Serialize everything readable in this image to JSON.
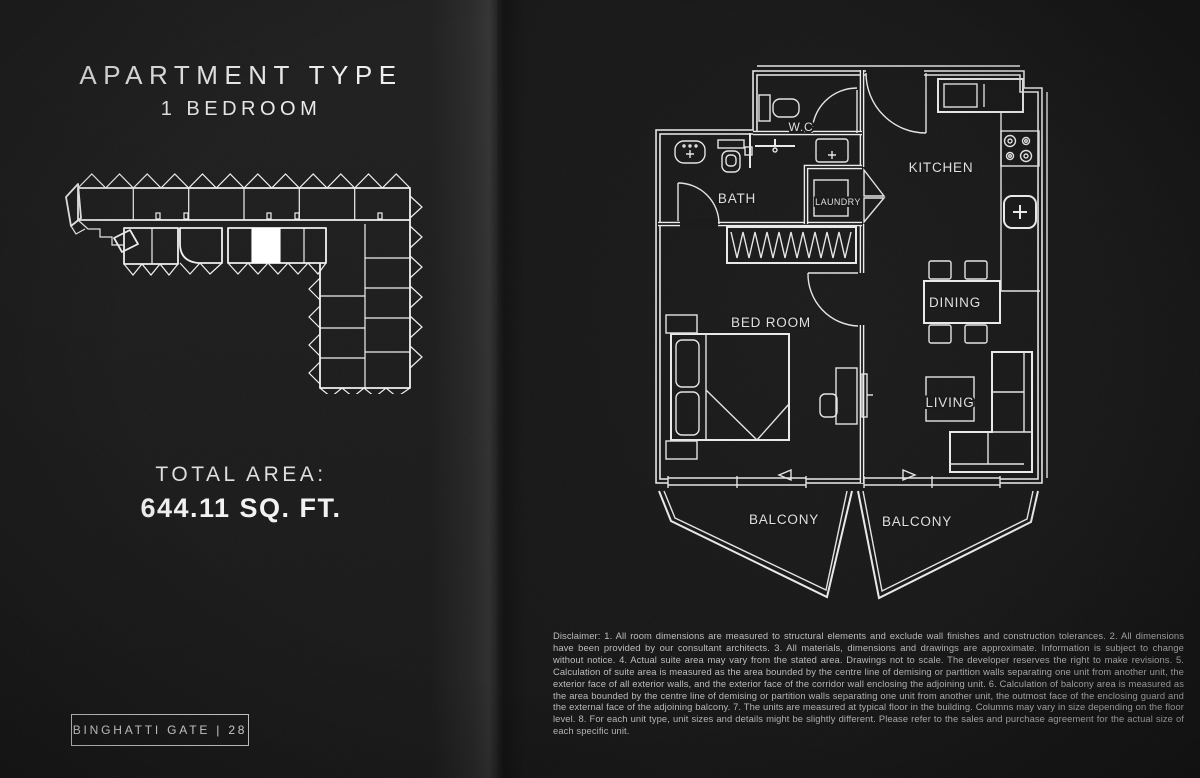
{
  "left_page": {
    "title": "APARTMENT TYPE",
    "subtitle": "1 BEDROOM",
    "total_area_label": "TOTAL AREA:",
    "total_area_value": "644.11 SQ. FT.",
    "badge": "BINGHATTI GATE | 28"
  },
  "floor_plan": {
    "rooms": {
      "wc": "W.C",
      "bath": "BATH",
      "laundry": "LAUNDRY",
      "kitchen": "KITCHEN",
      "bedroom": "BED ROOM",
      "dining": "DINING",
      "living": "LIVING",
      "balcony_left": "BALCONY",
      "balcony_right": "BALCONY"
    }
  },
  "disclaimer": "Disclaimer: 1. All room dimensions are measured to structural elements and exclude wall finishes and construction tolerances. 2. All dimensions have been provided by our consultant architects. 3. All materials, dimensions and drawings are approximate. Information is subject to change without notice. 4. Actual suite area may vary from the stated area. Drawings not to scale. The developer reserves the right to make revisions. 5. Calculation of suite area is measured as the area bounded by the centre line of demising or partition walls separating one unit from another unit, the exterior face of all exterior walls, and the exterior face of the corridor wall enclosing the adjoining unit. 6. Calculation of balcony area is measured as the area bounded by the centre line of demising or partition walls separating one unit from another unit, the outmost face of the enclosing guard and the external face of the adjoining balcony. 7. The units are measured at typical floor in the building. Columns may vary in size depending on the floor level. 8. For each unit type, unit sizes and details might be slightly different. Please refer to the sales and purchase agreement for the actual size of each specific unit.",
  "colors": {
    "page_background": "#181818",
    "plan_line": "#ececec",
    "heading_text": "#efefef",
    "disclaimer_text": "#bdbdbd",
    "highlighted_unit": "#ffffff"
  }
}
